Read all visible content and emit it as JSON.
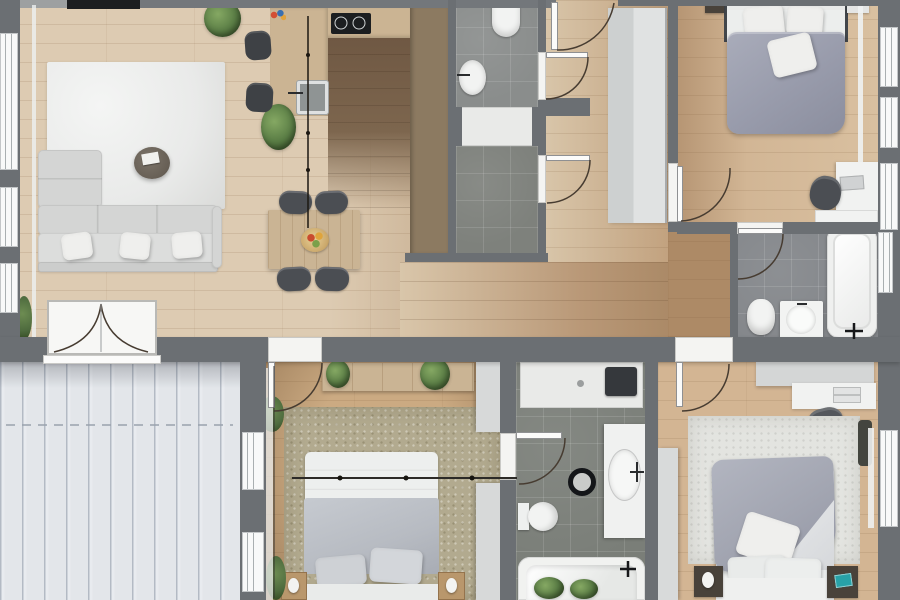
{
  "meta": {
    "kind": "apartment-floor-plan-render",
    "view": "top-down",
    "width_px": 900,
    "height_px": 600
  },
  "palette": {
    "wall": "#6b6f73",
    "wall_light": "#9da0a1",
    "wood_light": "#dccab1",
    "wood_mid": "#c8ab88",
    "wood_dark": "#a9855f",
    "wood_kitchen": "#7b6249",
    "counter": "#cbb493",
    "cabinet_brown": "#8c7a61",
    "tile_a": "#8a8d8c",
    "tile_b": "#7e817c",
    "tile_c": "#83868a",
    "tile_d": "#7a7e78",
    "fixture_white": "#f2f3f2",
    "shower_white": "#e9eae8",
    "deck": "#e3e6ea",
    "deck_stripe": "#aeb6c2",
    "rug_living": "#e9eae9",
    "rug_green": "#b2aa8f",
    "rug_white": "#e3e4e0",
    "sofa": "#d4d5d4",
    "closet": "#d7d9d9",
    "duvet_bed1": "#989bab",
    "duvet_bed3": "#a2a5b1",
    "blanket_bed2": "#b7bbc2",
    "chair": "#4b4e53",
    "stool": "#3e4145",
    "table_wood": "#cab494",
    "nightstand_wood": "#b9976c",
    "nightstand_dark": "#49423a",
    "plant": "#5a7d45",
    "plant_dark": "#4e6b3e",
    "tv": "#1c1e20",
    "black_fitting": "#17181a",
    "door_line": "#473c31",
    "accent_teal": "#28a2a8"
  },
  "rooms": [
    {
      "name": "living-room",
      "objects": [
        "corner-sofa",
        "white-rug",
        "round-coffee-table",
        "tv",
        "plants",
        "window-wall",
        "curtain"
      ]
    },
    {
      "name": "kitchen",
      "objects": [
        "l-shaped-counter",
        "cooktop",
        "sink",
        "bar-stools",
        "tall-cabinet-block",
        "pendant-lamp",
        "plant"
      ]
    },
    {
      "name": "dining-area",
      "objects": [
        "dining-table",
        "four-chairs",
        "fruit-bowl",
        "pendant-cable"
      ]
    },
    {
      "name": "hallway",
      "objects": [
        "entry-door",
        "storage-closet"
      ]
    },
    {
      "name": "shower-room-top",
      "objects": [
        "toilet",
        "washbasin",
        "shower-tray",
        "two-doors"
      ]
    },
    {
      "name": "bedroom-top-right",
      "objects": [
        "double-bed",
        "wardrobe",
        "desk",
        "office-chair",
        "nightstands",
        "curtain",
        "windows"
      ]
    },
    {
      "name": "bathroom-right",
      "objects": [
        "bathtub",
        "toilet",
        "vanity-washbasin",
        "door",
        "window"
      ]
    },
    {
      "name": "terrace",
      "objects": [
        "plank-decking",
        "french-double-door",
        "windows"
      ]
    },
    {
      "name": "bedroom-bottom-middle",
      "objects": [
        "double-bed",
        "green-rug",
        "sideboard",
        "plants",
        "nightstands",
        "lamps",
        "wardrobe",
        "curtain"
      ]
    },
    {
      "name": "bathroom-bottom",
      "objects": [
        "shower",
        "toilet",
        "vanity-washbasin",
        "bathtub",
        "round-stool",
        "plants",
        "door"
      ]
    },
    {
      "name": "bedroom-bottom-right",
      "objects": [
        "double-bed",
        "white-rug",
        "dresser",
        "desk",
        "pouf",
        "nightstands",
        "teal-book",
        "window",
        "curtain",
        "wardrobe"
      ]
    }
  ],
  "doors": [
    {
      "name": "front-door",
      "swing": "into-hallway"
    },
    {
      "name": "shower-room-door-upper",
      "swing": "into-hallway"
    },
    {
      "name": "shower-room-door-lower",
      "swing": "into-hallway"
    },
    {
      "name": "bedroom-top-right-door",
      "swing": "into-bedroom"
    },
    {
      "name": "bathroom-right-door",
      "swing": "into-bathroom"
    },
    {
      "name": "terrace-french-door",
      "swing": "double-into-living-room"
    },
    {
      "name": "bedroom-bottom-middle-door",
      "swing": "into-bedroom"
    },
    {
      "name": "bathroom-bottom-door",
      "swing": "into-bathroom"
    },
    {
      "name": "bedroom-bottom-right-door",
      "swing": "into-bedroom"
    }
  ]
}
